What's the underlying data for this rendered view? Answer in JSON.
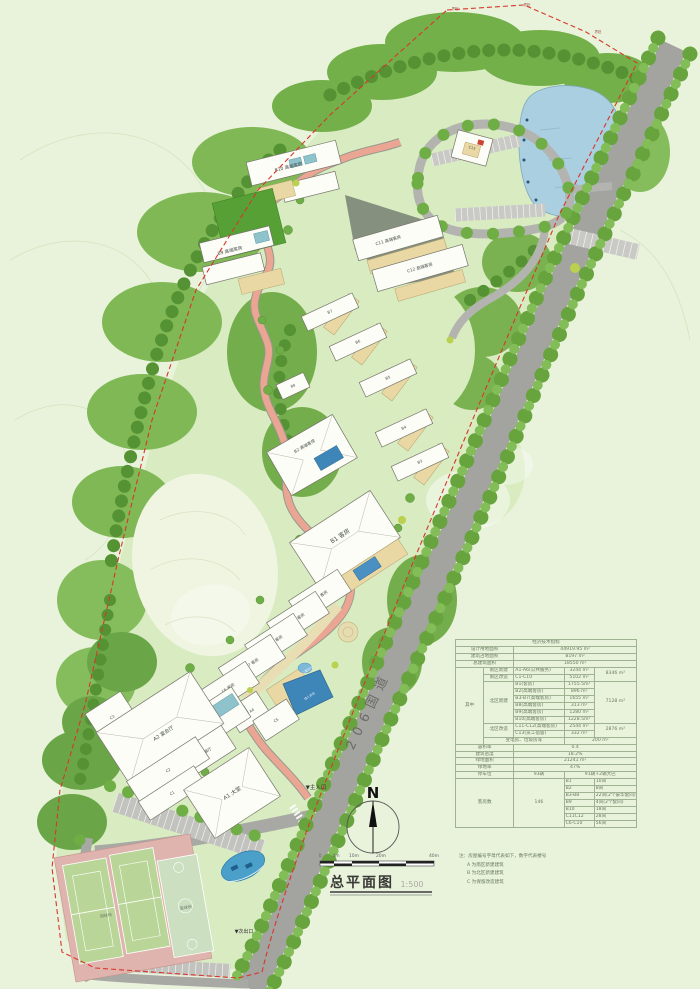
{
  "page": {
    "background": "#e9f3dc"
  },
  "title_block": {
    "title": "总平面图",
    "scale": "1:500"
  },
  "north": {
    "label": "N"
  },
  "scale_bar": {
    "ticks": [
      "0",
      "4m",
      "10m",
      "20m",
      "40m"
    ]
  },
  "map": {
    "labels": {
      "a1": "A1 大堂",
      "a2": "A2 宴会厅",
      "a3": "A3 餐厅",
      "a4": "A4",
      "c1": "C1",
      "c2": "C2",
      "c3": "C3",
      "c4": "C4 餐厅",
      "c5": "C5",
      "c6": "C6 客房",
      "c7": "C7 客房",
      "c8": "C8 客房",
      "c9": "C9 客房",
      "c10": "C10 客房",
      "b1": "B1 客房",
      "b2": "B2 高端客房",
      "b3": "B3",
      "b4": "B4",
      "b5": "B5",
      "b6": "B6",
      "b7": "B7",
      "b8": "B8",
      "b9": "B9 高端客房",
      "b10": "B10 高端客房",
      "c11": "C11 高端客房",
      "c12": "C12 高端客房",
      "c13": "C13",
      "main_entrance": "▼主入口",
      "secondary_exit": "▼次出口",
      "road_name": "206国道",
      "tennis": "网球场",
      "basketball": "篮球场",
      "adult_pool": "成人泳池",
      "kids_pool": "儿童泳池",
      "stake": "界桩"
    }
  },
  "indicators": {
    "title": "经济技术指标",
    "land_label": "设计用地面积",
    "land_value": "44919.95 m²",
    "footprint_label": "建筑占地面积",
    "footprint_value": "8197  m²",
    "gfa_label": "总建筑面积",
    "gfa_value": "18550  m²",
    "among_label": "其中",
    "south_new_label": "南区新建",
    "south_new_item": "A1-A6(公共服务)",
    "south_new_area": "3244 m²",
    "south_ren_label": "南区改造",
    "south_ren_item": "C1-C10",
    "south_ren_area": "5102 m²",
    "south_subtotal": "8346 m²",
    "north_new_label": "北区新建",
    "b1_item": "B1(客房)",
    "b1_area": "1755.5m²",
    "b2_item": "B2(高端客房)",
    "b2_area": "896  m²",
    "b3_item": "B3-B7(高端客房)",
    "b3_area": "1655  m²",
    "b8_item": "B8(高端客房)",
    "b8_area": "313  m²",
    "b9_item": "B9(高端客房)",
    "b9_area": "1280  m²",
    "b10_item": "B10(高端客房)",
    "b10_area": "1228.5m²",
    "north_subtotal": "7128 m²",
    "north_ren_label": "北区改造",
    "c11_item": "C11-C12(高端客房)",
    "c11_area": "2544 m²",
    "c13_item": "C13(员工宿舍)",
    "c13_area": "332  m²",
    "north_ren_subtotal": "2876 m²",
    "utility_label": "变电房、垃圾房等",
    "utility_area": "200  m²",
    "far_label": "容积率",
    "far_value": "0.4",
    "density_label": "建筑密度",
    "density_value": "18.2%",
    "green_area_label": "绿地面积",
    "green_area_value": "21241  m²",
    "green_rate_label": "绿地率",
    "green_rate_value": "47%",
    "parking_label": "停车位",
    "parking_count": "93辆",
    "parking_detail": "91辆+2辆大巴",
    "rooms_label": "客房数",
    "rooms_total": "146",
    "rooms": {
      "b1": "B1",
      "b1_v": "10间",
      "b2": "B2",
      "b2_v": "8间",
      "b3": "B3-B8",
      "b3_v": "22间(2个豪华套间)",
      "b9": "B9",
      "b9_v": "4间(2个套间)",
      "b10": "B10",
      "b10_v": "18间",
      "c11": "C11C12",
      "c11_v": "28间",
      "c6": "C6-C10",
      "c6_v": "56间"
    }
  },
  "notes": {
    "n0": "注：房屋编号字母代表如下，数字代表楼号",
    "n1": "A 为南区新建建筑",
    "n2": "B 为北区新建建筑",
    "n3": "C 为保留改造建筑"
  }
}
